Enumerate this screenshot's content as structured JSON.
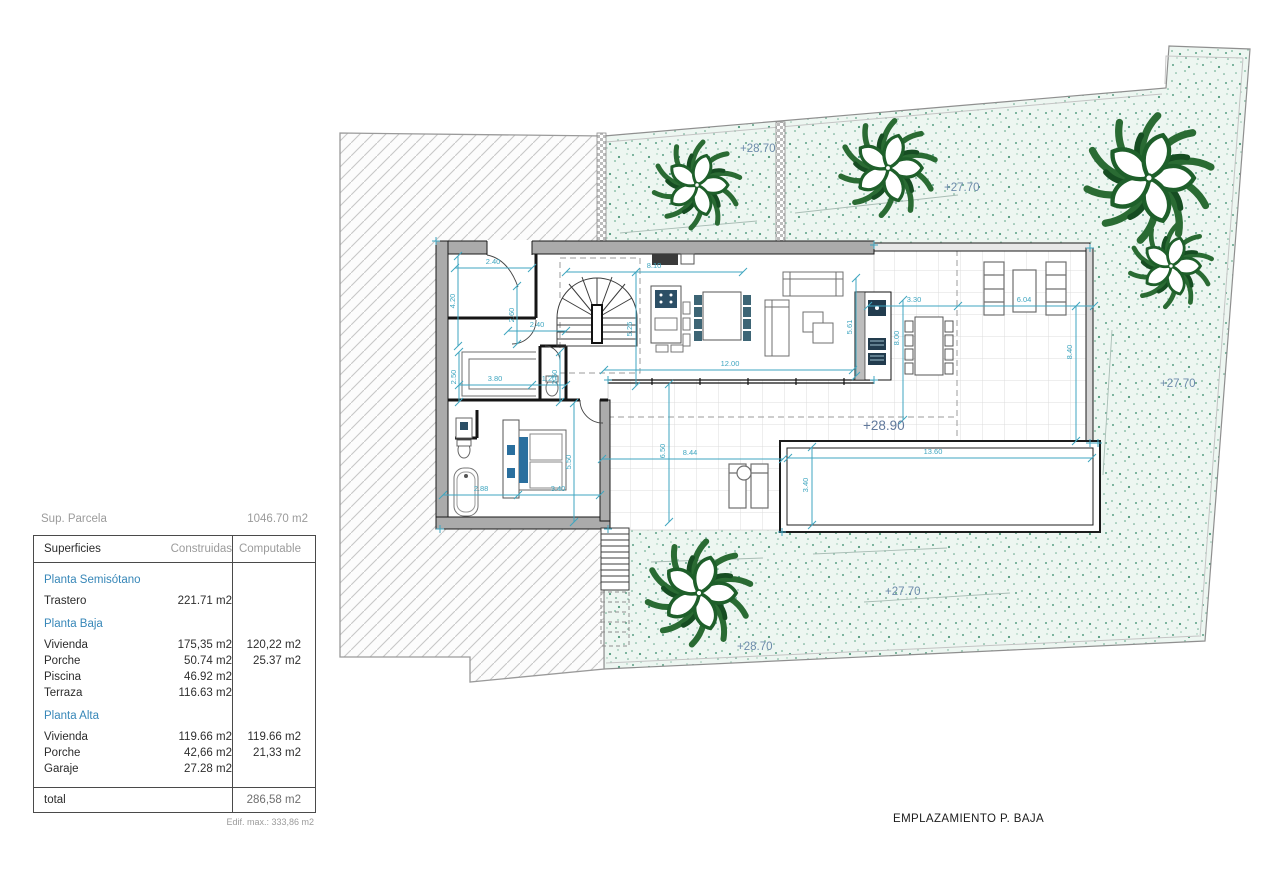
{
  "plan": {
    "title": "EMPLAZAMIENTO P. BAJA",
    "elevation_labels": [
      "+28.70",
      "+27.70",
      "+27.70",
      "+28.90",
      "+27.70",
      "+28.70"
    ],
    "dimension_labels": [
      "2.40",
      "4.20",
      "2.60",
      "2.40",
      "8.10",
      "5.26",
      "12.00",
      "2.50",
      "3.80",
      "1.20",
      "2.50",
      "2.88",
      "3.40",
      "5.50",
      "5.61",
      "3.30",
      "8.00",
      "6.04",
      "8.40",
      "8.44",
      "6.50",
      "3.40",
      "13.60"
    ]
  },
  "parcel": {
    "label": "Sup. Parcela",
    "value": "1046.70 m2"
  },
  "surfaces_table": {
    "headers": {
      "name": "Superficies",
      "built": "Construidas",
      "computable": "Computable"
    },
    "sections": [
      {
        "title": "Planta Semisótano",
        "rows": [
          {
            "name": "Trastero",
            "built": "221.71 m2",
            "computable": ""
          }
        ]
      },
      {
        "title": "Planta Baja",
        "rows": [
          {
            "name": "Vivienda",
            "built": "175,35 m2",
            "computable": "120,22 m2"
          },
          {
            "name": "Porche",
            "built": "50.74 m2",
            "computable": "25.37 m2"
          },
          {
            "name": "Piscina",
            "built": "46.92 m2",
            "computable": ""
          },
          {
            "name": "Terraza",
            "built": "116.63 m2",
            "computable": ""
          }
        ]
      },
      {
        "title": "Planta Alta",
        "rows": [
          {
            "name": "Vivienda",
            "built": "119.66 m2",
            "computable": "119.66 m2"
          },
          {
            "name": "Porche",
            "built": "42,66 m2",
            "computable": "21,33 m2"
          },
          {
            "name": "Garaje",
            "built": "27.28 m2",
            "computable": ""
          }
        ]
      }
    ],
    "total": {
      "label": "total",
      "value": "286,58 m2"
    },
    "footnote": "Edif. max.: 333,86 m2"
  },
  "colors": {
    "dimension": "#3fa6c0",
    "elevation": "#6d8bab",
    "section_header": "#3787b8",
    "plant_green": "#1e5f2a",
    "stipple_background": "#edf6f1"
  }
}
